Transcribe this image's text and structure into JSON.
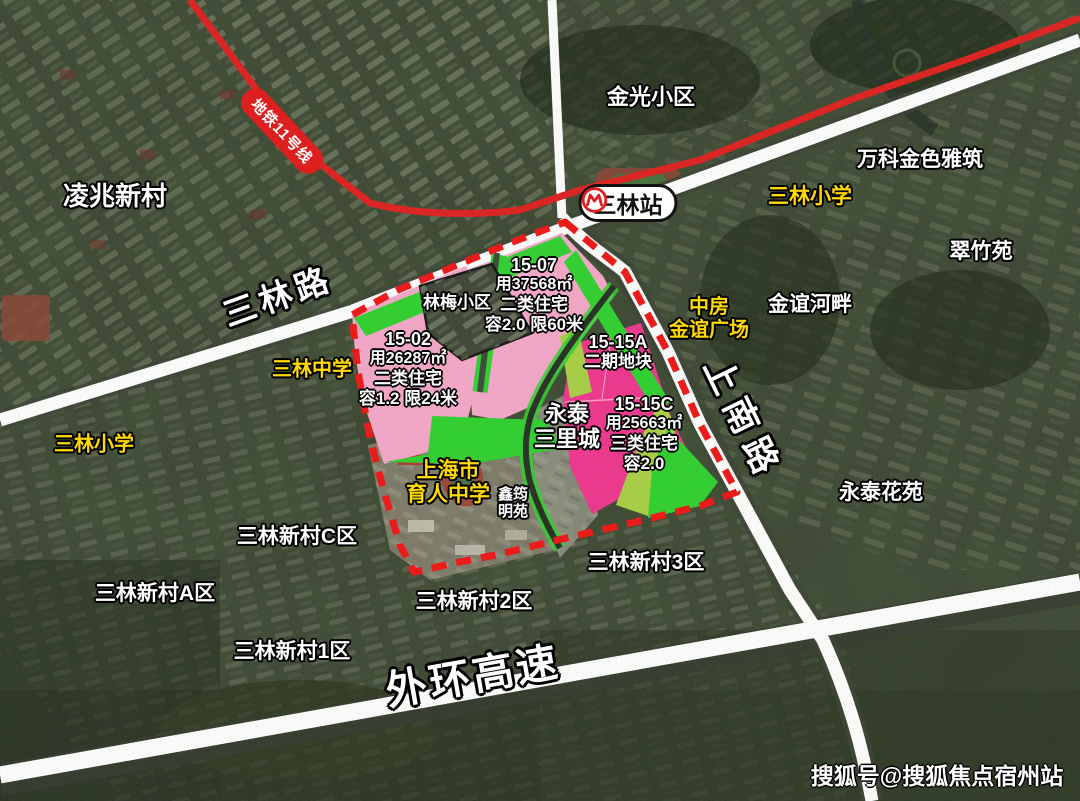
{
  "map": {
    "watermark": "搜狐号@搜狐焦点宿州站",
    "metro": {
      "line_label": "地铁11号线",
      "station_badge": "三林站"
    },
    "roads": {
      "sanlin_road": "三林路",
      "shangnan_road": "上南路",
      "waihuan_expressway": "外环高速"
    },
    "places": {
      "lingzhao_xincun": "凌兆新村",
      "jinguang_xiaoqu": "金光小区",
      "vanke_jinse_yazhu": "万科金色雅筑",
      "sanlin_primary_east": "三林小学",
      "cuizhuyuan": "翠竹苑",
      "jinyi_hepan": "金谊河畔",
      "zhongfang_line1": "中房",
      "zhongfang_line2": "金谊广场",
      "linmei_xiaoqu": "林梅小区",
      "sanlin_middle_school": "三林中学",
      "sanlin_primary_west": "三林小学",
      "yongtai_line1": "永泰",
      "yongtai_line2": "三里城",
      "yuren_line1": "上海市",
      "yuren_line2": "育人中学",
      "xinyun_line1": "鑫筠",
      "xinyun_line2": "明苑",
      "xincun_c": "三林新村C区",
      "xincun_a": "三林新村A区",
      "xincun_1": "三林新村1区",
      "xincun_2": "三林新村2区",
      "xincun_3": "三林新村3区",
      "yongtai_huayuan": "永泰花苑"
    },
    "parcels": {
      "p15_07": {
        "id": "15-07",
        "area": "用37568㎡",
        "type": "二类住宅",
        "far": "容2.0 限60米"
      },
      "p15_02": {
        "id": "15-02",
        "area": "用26287㎡",
        "type": "二类住宅",
        "far": "容1.2 限24米"
      },
      "p15_15a": {
        "id": "15-15A",
        "note": "二期地块"
      },
      "p15_15c": {
        "id": "15-15C",
        "area": "用25663㎡",
        "type": "三类住宅",
        "far": "容2.0"
      }
    },
    "colors": {
      "light_pink": "#f6a7c9",
      "magenta": "#f0348e",
      "bright_green": "#2ed12e",
      "olive_green": "#a8cf44",
      "metro_red": "#de1f1f",
      "boundary_red": "#f01414",
      "label_yellow": "#ffd900"
    }
  }
}
